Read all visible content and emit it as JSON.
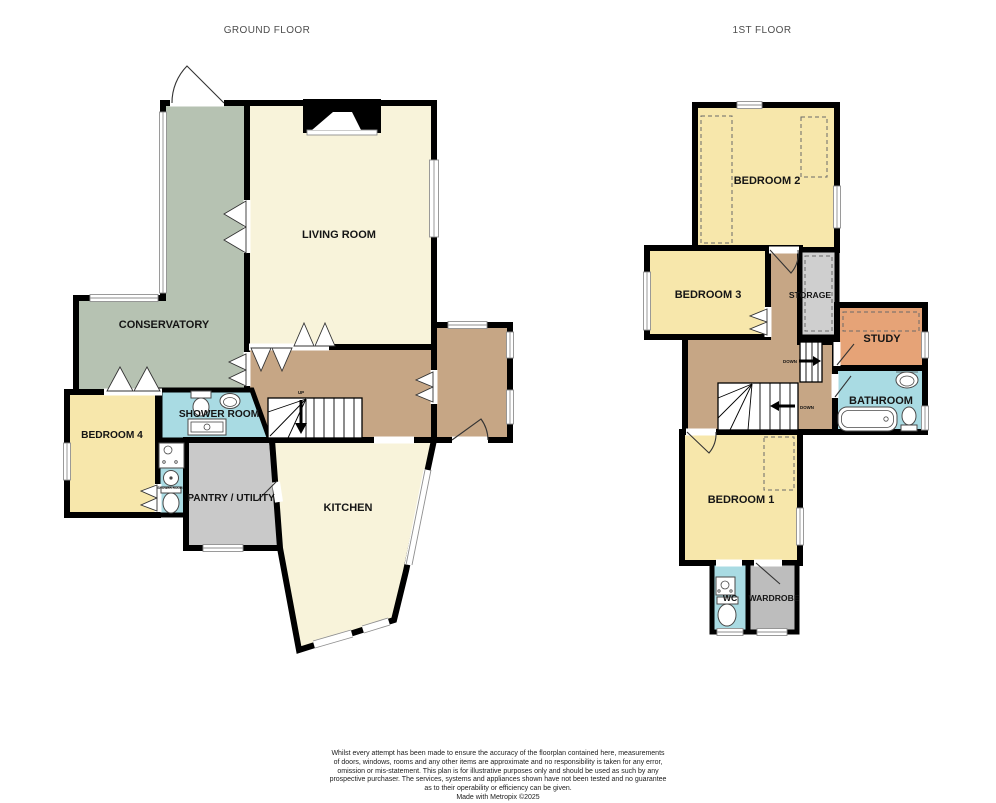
{
  "header": {
    "ground_floor_title": "GROUND FLOOR",
    "first_floor_title": "1ST FLOOR"
  },
  "ground_floor": {
    "rooms": {
      "living_room": "LIVING ROOM",
      "conservatory": "CONSERVATORY",
      "bedroom_4": "BEDROOM 4",
      "shower_room": "SHOWER ROOM",
      "ensuite_label": "SHOWER ROOM",
      "pantry_utility": "PANTRY / UTILITY",
      "kitchen": "KITCHEN"
    },
    "stairs": {
      "up_label": "UP"
    }
  },
  "first_floor": {
    "rooms": {
      "bedroom_1": "BEDROOM 1",
      "bedroom_2": "BEDROOM 2",
      "bedroom_3": "BEDROOM 3",
      "storage": "STORAGE",
      "study": "STUDY",
      "bathroom": "BATHROOM",
      "wc": "WC",
      "wardrobe": "WARDROBE"
    },
    "stairs": {
      "down_upper_label": "DOWN",
      "down_lower_label": "DOWN"
    }
  },
  "colors": {
    "wall": "#000000",
    "cream": "#F8F3DA",
    "sage": "#B6C2B2",
    "yellow": "#F7E7AB",
    "tan": "#C6A685",
    "gray_pantry": "#C9C9C9",
    "gray_wardrobe": "#BDBDBD",
    "gray_storage": "#CFCFCF",
    "blue": "#A9DBE3",
    "orange": "#E6A377"
  },
  "footer": {
    "lines": [
      "Whilst every attempt has been made to ensure the accuracy of the floorplan contained here, measurements",
      "of doors, windows, rooms and any other items are approximate and no responsibility is taken for any error,",
      "omission or mis-statement. This plan is for illustrative purposes only and should be used as such by any",
      "prospective purchaser. The services, systems and appliances shown have not been tested and no guarantee",
      "as to their operability or efficiency can be given."
    ],
    "credit": "Made with Metropix ©2025"
  }
}
